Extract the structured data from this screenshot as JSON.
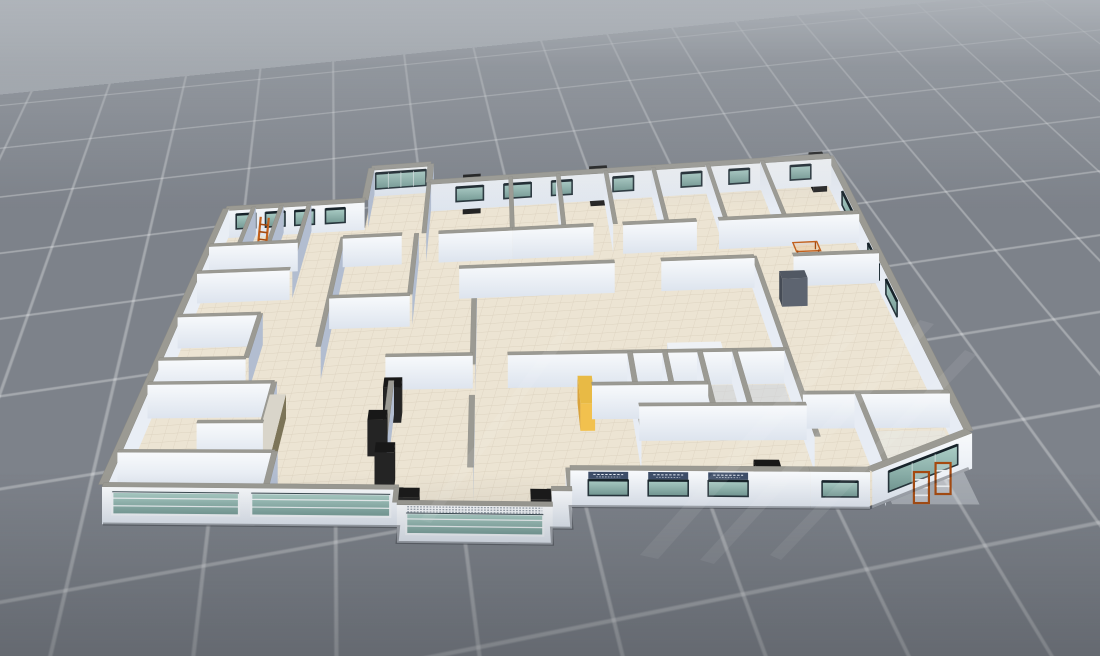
{
  "viewport": {
    "kind": "3d-floor-plan-view",
    "ground_grid": true
  },
  "palette": {
    "bg_top": "#a9aeb4",
    "bg_bottom": "#73787f",
    "grid_plane": "#7d828a",
    "grid_line": "#b9bec3",
    "floor": "#ece4d3",
    "floor_line": "#dbd1bd",
    "lobby_floor": "#44546f",
    "wall_face": "#f4f7fa",
    "wall_face_shadow": "#ccd4e0",
    "wall_side_dark": "#b2bdd0",
    "wall_side_light": "#e7ecf4",
    "wall_side_bright": "#e9eef5",
    "wall_cap": "#9b9a93",
    "glass_light": "#a8ccc4",
    "glass_dark": "#6d948e",
    "glass_frame_dark": "#26343b",
    "glass_frame_white": "#eef2f6",
    "black_block": "#1d1d1d",
    "gray_door": "#5d6470",
    "accent_orange": "#c2601c",
    "accent_orange_deep": "#a54a10",
    "cabinet_yellow": "#f2c14e",
    "cabinet_yellow_side": "#d9a33c",
    "sign_bg": "#3d4d68",
    "sign_text": "#e6ecf5",
    "locker_olive": "#7c7458",
    "counter_white": "#f3f5f8",
    "stair": "#62718a",
    "stair_step": "#dfe4ec"
  },
  "scene": {
    "building": {
      "plan_width_m": 44,
      "plan_depth_m": 30,
      "wall_height_m": 3,
      "outline": [
        [
          0,
          0
        ],
        [
          14.5,
          0
        ],
        [
          14.5,
          -1.5
        ],
        [
          22,
          -1.5
        ],
        [
          22,
          0
        ],
        [
          23,
          0
        ],
        [
          23,
          2
        ],
        [
          38,
          2
        ],
        [
          44,
          5.5
        ],
        [
          44,
          30
        ],
        [
          14.5,
          30
        ],
        [
          14.5,
          31.8
        ],
        [
          10,
          31.8
        ],
        [
          10,
          28.6
        ],
        [
          0,
          28.6
        ]
      ],
      "walls": [
        {
          "seg": [
            0,
            0,
            14.5,
            0
          ],
          "th": 0.45,
          "win": [
            {
              "a": 0.5,
              "b": 6.7,
              "z1": 0.8,
              "z2": 2.6,
              "style": "band"
            },
            {
              "a": 7.3,
              "b": 14.1,
              "z1": 0.8,
              "z2": 2.6,
              "style": "band"
            }
          ]
        },
        {
          "seg": [
            14.5,
            -1.5,
            14.5,
            0
          ],
          "th": 0.45
        },
        {
          "seg": [
            14.5,
            -1.5,
            22,
            -1.5
          ],
          "th": 0.45,
          "trows": true,
          "win": [
            {
              "a": 0.45,
              "b": 7.05,
              "z1": 0.7,
              "z2": 2.35,
              "style": "band"
            }
          ]
        },
        {
          "seg": [
            22,
            -1.5,
            22,
            0
          ],
          "th": 0.45
        },
        {
          "seg": [
            22,
            0,
            23,
            0
          ],
          "th": 0.45
        },
        {
          "seg": [
            23,
            0,
            23,
            2
          ],
          "th": 0.45
        },
        {
          "seg": [
            23,
            2,
            35,
            2
          ],
          "th": 0.45,
          "signs": [
            [
              0.9,
              2.9
            ],
            [
              3.9,
              5.9
            ],
            [
              6.9,
              8.9
            ]
          ],
          "win": [
            {
              "a": 0.9,
              "b": 2.9,
              "z1": 0.95,
              "z2": 2.2,
              "style": "dark"
            },
            {
              "a": 3.9,
              "b": 5.9,
              "z1": 0.95,
              "z2": 2.2,
              "style": "dark"
            },
            {
              "a": 6.9,
              "b": 8.9,
              "z1": 0.95,
              "z2": 2.2,
              "style": "dark"
            }
          ]
        },
        {
          "seg": [
            35,
            2,
            38,
            2
          ],
          "th": 0.45,
          "win": [
            {
              "a": 0.6,
              "b": 2.4,
              "z1": 0.95,
              "z2": 2.2,
              "style": "dark"
            }
          ]
        },
        {
          "seg": [
            38,
            2,
            44,
            5.5
          ],
          "th": 0.45,
          "win": [
            {
              "a": 1.1,
              "b": 5.9,
              "z1": 0.85,
              "z2": 2.5,
              "style": "dark",
              "mull": 3
            }
          ]
        },
        {
          "seg": [
            44,
            5.5,
            44,
            30
          ],
          "th": 0.45,
          "win": [
            {
              "a": 12,
              "b": 14,
              "z1": 1,
              "z2": 2.5,
              "style": "dark"
            },
            {
              "a": 15.2,
              "b": 17.2,
              "z1": 1,
              "z2": 2.5,
              "style": "dark"
            },
            {
              "a": 20,
              "b": 21.8,
              "z1": 1,
              "z2": 2.5,
              "style": "dark"
            }
          ]
        },
        {
          "seg": [
            14.5,
            30,
            44,
            30
          ],
          "th": 0.45,
          "win": [
            {
              "a": 2,
              "b": 4,
              "z1": 0.9,
              "z2": 2.45,
              "style": "dark"
            },
            {
              "a": 5.5,
              "b": 7.5,
              "z1": 0.9,
              "z2": 2.45,
              "style": "dark"
            },
            {
              "a": 9,
              "b": 10.5,
              "z1": 0.9,
              "z2": 2.45,
              "style": "dark"
            },
            {
              "a": 13.5,
              "b": 15,
              "z1": 0.9,
              "z2": 2.45,
              "style": "dark"
            },
            {
              "a": 18.5,
              "b": 20,
              "z1": 0.9,
              "z2": 2.45,
              "style": "dark"
            },
            {
              "a": 22,
              "b": 23.5,
              "z1": 0.9,
              "z2": 2.45,
              "style": "dark"
            },
            {
              "a": 26.5,
              "b": 28,
              "z1": 0.9,
              "z2": 2.45,
              "style": "dark"
            }
          ]
        },
        {
          "seg": [
            10,
            31.8,
            14.5,
            31.8
          ],
          "th": 0.45,
          "win": [
            {
              "a": 0.35,
              "b": 4.15,
              "z1": 0.85,
              "z2": 2.6,
              "style": "dark",
              "mull": 4
            }
          ]
        },
        {
          "seg": [
            10,
            28.6,
            10,
            31.8
          ],
          "th": 0.45
        },
        {
          "seg": [
            14.5,
            30,
            14.5,
            31.8
          ],
          "th": 0.45
        },
        {
          "seg": [
            0,
            28.6,
            10,
            28.6
          ],
          "th": 0.45,
          "win": [
            {
              "a": 0.8,
              "b": 2.2,
              "z1": 0.95,
              "z2": 2.5,
              "style": "dark"
            },
            {
              "a": 2.9,
              "b": 4.3,
              "z1": 0.95,
              "z2": 2.5,
              "style": "dark"
            },
            {
              "a": 5,
              "b": 6.4,
              "z1": 0.95,
              "z2": 2.5,
              "style": "dark"
            },
            {
              "a": 7.2,
              "b": 8.6,
              "z1": 0.95,
              "z2": 2.5,
              "style": "dark"
            }
          ]
        },
        {
          "seg": [
            0,
            0,
            0,
            28.6
          ],
          "th": 0.45
        },
        {
          "seg": [
            0,
            22,
            6,
            22
          ],
          "th": 0.3
        },
        {
          "seg": [
            6,
            22,
            6,
            28.6
          ],
          "th": 0.3
        },
        {
          "seg": [
            0,
            24.8,
            6,
            24.8
          ],
          "th": 0.3
        },
        {
          "seg": [
            2,
            24.8,
            2,
            28.6
          ],
          "th": 0.3
        },
        {
          "seg": [
            4,
            24.8,
            4,
            28.6
          ],
          "th": 0.3
        },
        {
          "seg": [
            0,
            17.5,
            5,
            17.5
          ],
          "th": 0.3
        },
        {
          "seg": [
            5,
            13,
            5,
            17.5
          ],
          "th": 0.3
        },
        {
          "seg": [
            0,
            13,
            5,
            13
          ],
          "th": 0.3
        },
        {
          "seg": [
            0,
            10.5,
            7,
            10.5
          ],
          "th": 0.3
        },
        {
          "seg": [
            7,
            3.5,
            7,
            10.5
          ],
          "th": 0.3
        },
        {
          "seg": [
            3.5,
            6.5,
            7,
            6.5
          ],
          "th": 0.3
        },
        {
          "seg": [
            0,
            3.5,
            8,
            3.5
          ],
          "th": 0.3
        },
        {
          "seg": [
            8,
            0,
            8,
            3.5
          ],
          "th": 0.3
        },
        {
          "seg": [
            9,
            14,
            9,
            25
          ],
          "th": 0.3
        },
        {
          "seg": [
            9,
            19,
            14,
            19
          ],
          "th": 0.3
        },
        {
          "seg": [
            14,
            19,
            14,
            25
          ],
          "th": 0.3
        },
        {
          "seg": [
            9,
            25,
            13,
            25
          ],
          "th": 0.3
        },
        {
          "seg": [
            15.5,
            25,
            20.5,
            25
          ],
          "th": 0.3
        },
        {
          "seg": [
            13.5,
            3.5,
            13.5,
            10.5
          ],
          "th": 0.3
        },
        {
          "seg": [
            18,
            2,
            18,
            9
          ],
          "th": 0.3
        },
        {
          "seg": [
            18,
            12,
            18,
            21.5
          ],
          "th": 0.3
        },
        {
          "seg": [
            13,
            13,
            18,
            13
          ],
          "th": 0.3
        },
        {
          "seg": [
            20,
            13,
            36,
            13
          ],
          "th": 0.3
        },
        {
          "seg": [
            24.6,
            10,
            31,
            10
          ],
          "th": 0.3
        },
        {
          "seg": [
            27,
            5,
            27,
            13
          ],
          "th": 0.3
        },
        {
          "seg": [
            27,
            8,
            36,
            8
          ],
          "th": 0.3
        },
        {
          "seg": [
            29,
            8,
            29,
            13
          ],
          "th": 0.3
        },
        {
          "seg": [
            31,
            8,
            31,
            13
          ],
          "th": 0.3
        },
        {
          "seg": [
            33,
            8,
            33,
            13
          ],
          "th": 0.3
        },
        {
          "seg": [
            36,
            5,
            36,
            13
          ],
          "th": 0.3
        },
        {
          "seg": [
            36,
            13,
            36,
            21.5
          ],
          "th": 0.3
        },
        {
          "seg": [
            36,
            9,
            44,
            9
          ],
          "th": 0.3
        },
        {
          "seg": [
            39,
            2,
            39,
            9
          ],
          "th": 0.3
        },
        {
          "seg": [
            17,
            21.5,
            27,
            21.5
          ],
          "th": 0.3
        },
        {
          "seg": [
            30,
            21.5,
            36,
            21.5
          ],
          "th": 0.3
        },
        {
          "seg": [
            38.5,
            21.5,
            44,
            21.5
          ],
          "th": 0.3
        },
        {
          "seg": [
            20.5,
            25,
            26,
            25
          ],
          "th": 0.3
        },
        {
          "seg": [
            28,
            25,
            33,
            25
          ],
          "th": 0.3
        },
        {
          "seg": [
            34.5,
            25,
            44,
            25
          ],
          "th": 0.3
        },
        {
          "seg": [
            20.5,
            25,
            20.5,
            30
          ],
          "th": 0.3
        },
        {
          "seg": [
            24,
            25,
            24,
            30
          ],
          "th": 0.3
        },
        {
          "seg": [
            27.5,
            25,
            27.5,
            30
          ],
          "th": 0.3
        },
        {
          "seg": [
            31,
            25,
            31,
            30
          ],
          "th": 0.3
        },
        {
          "seg": [
            35,
            25,
            35,
            30
          ],
          "th": 0.3
        },
        {
          "seg": [
            39,
            25,
            39,
            30
          ],
          "th": 0.3
        },
        {
          "seg": [
            14.5,
            25,
            14.5,
            30
          ],
          "th": 0.3
        }
      ],
      "boxes": [
        {
          "r": [
            13.1,
            9.7,
            1,
            1
          ],
          "h": 3.1,
          "c": "black",
          "name": "pillar"
        },
        {
          "r": [
            12.5,
            6.5,
            1,
            1
          ],
          "h": 3.1,
          "c": "black",
          "name": "pillar"
        },
        {
          "r": [
            13.1,
            3.3,
            1,
            1
          ],
          "h": 3.1,
          "c": "black",
          "name": "pillar"
        },
        {
          "r": [
            14.55,
            -1.35,
            1,
            1
          ],
          "h": 3.25,
          "c": "black",
          "name": "pillar"
        },
        {
          "r": [
            20.95,
            -1.35,
            1,
            1
          ],
          "h": 3.25,
          "c": "black",
          "name": "pillar"
        },
        {
          "r": [
            26.3,
            29.3,
            1.3,
            0.9
          ],
          "h": 3.35,
          "c": "black",
          "name": "door-top"
        },
        {
          "r": [
            17,
            29.3,
            1.3,
            0.9
          ],
          "h": 3.35,
          "c": "black",
          "name": "door-top"
        },
        {
          "r": [
            42.5,
            29.3,
            1,
            0.9
          ],
          "h": 3.3,
          "c": "black",
          "name": "door-top"
        },
        {
          "r": [
            37.3,
            19.6,
            1.6,
            0.7
          ],
          "h": 2.75,
          "c": "gray",
          "name": "door-leaf"
        },
        {
          "r": [
            32.4,
            2.3,
            1.3,
            1
          ],
          "h": 2.6,
          "c": "black",
          "name": "door-block"
        },
        {
          "r": [
            23.9,
            8.8,
            0.8,
            2.6
          ],
          "h": 2.4,
          "c": "yellow",
          "name": "yellow-cabinet"
        },
        {
          "r": [
            6.8,
            4,
            0.9,
            6.2
          ],
          "h": 2.15,
          "c": "olive",
          "name": "locker-row"
        },
        {
          "r": [
            29.5,
            14.8,
            3.2,
            0.9
          ],
          "h": 1.05,
          "c": "white",
          "name": "counter"
        }
      ],
      "patches": [
        {
          "rect": [
            0.35,
            0.25,
            7.55,
            3.05
          ],
          "fill": "#44546f",
          "op": 1,
          "name": "lobby-floor"
        },
        {
          "rect": [
            0.4,
            2.5,
            7.5,
            0.8
          ],
          "fill": "#eef1f5",
          "op": 0.95,
          "name": "lobby-white-strip"
        },
        {
          "rect": [
            0.4,
            0.3,
            7.5,
            0.6
          ],
          "fill": "#7fa8a8",
          "op": 0.35,
          "name": "lobby-glass-reflection"
        },
        {
          "rect": [
            27.2,
            8.2,
            8.6,
            4.6
          ],
          "fill": "#ccd4e0",
          "op": 0.55,
          "name": "wet-room-floor"
        },
        {
          "rect": [
            39.2,
            2.2,
            4.4,
            6.4
          ],
          "fill": "#e3e8ee",
          "op": 0.4,
          "name": "storage-room-floor"
        }
      ],
      "floor_label_strips": [
        [
          11.5,
          1.05,
          15.1
        ],
        [
          11.5,
          1.6,
          15.1
        ]
      ],
      "stairs": {
        "rect": [
          5.3,
          0.8,
          2.4,
          2.3
        ]
      },
      "furniture": {
        "ladder": {
          "at": [
            3.05,
            25.1
          ]
        },
        "desk": {
          "at": [
            40.1,
            24.1
          ]
        },
        "racks": [
          [
            40.7,
            2.3
          ],
          [
            42,
            3.1
          ]
        ],
        "chairs": [
          [
            3.2,
            1.5
          ],
          [
            2.3,
            2.0
          ]
        ]
      }
    }
  }
}
